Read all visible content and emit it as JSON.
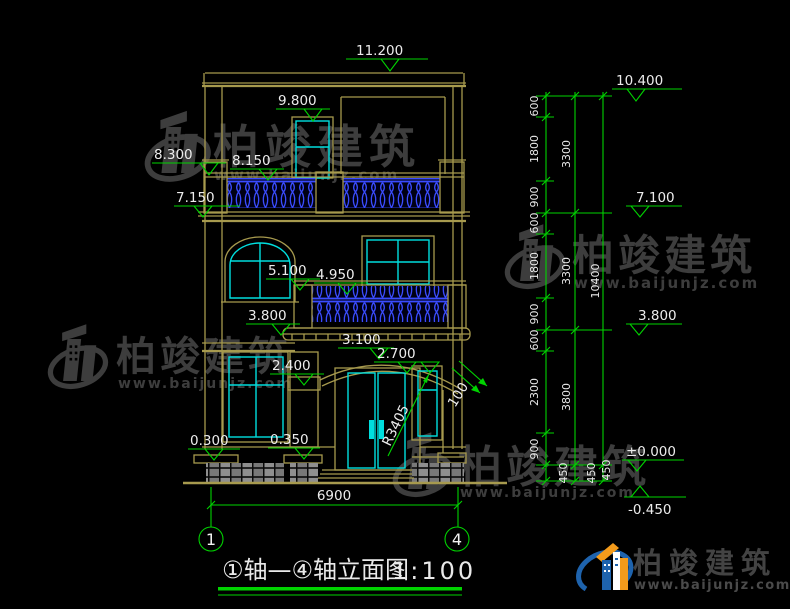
{
  "title": {
    "text": "①轴—④轴立面图",
    "scale": "1:100"
  },
  "axes": {
    "first": "1",
    "last": "4"
  },
  "elev_left": [
    "11.200",
    "9.800",
    "8.300",
    "8.150",
    "7.150",
    "5.100",
    "4.950",
    "3.800",
    "3.100",
    "2.700",
    "2.400",
    "0.300",
    "0.350"
  ],
  "elev_right": [
    "10.400",
    "7.100",
    "3.800",
    "±0.000",
    "-0.450"
  ],
  "chain_inner": [
    "600",
    "1800",
    "900",
    "600",
    "1800",
    "900",
    "600",
    "2300",
    "900",
    "450"
  ],
  "chain_mid": [
    "3300",
    "3300",
    "3800",
    "450"
  ],
  "chain_outer": [
    "10400",
    "450"
  ],
  "dims": {
    "overall_width": "6900",
    "door_arch_radius": "R3405",
    "arch_offset": "100"
  },
  "watermark": {
    "brand": "柏竣建筑",
    "url": "www.baijunjz.com"
  },
  "logo": {
    "brand": "柏竣建筑",
    "url": "www.baijunjz.com"
  },
  "colors": {
    "outline": "#a79a4e",
    "glazing": "#00dede",
    "dimension": "#00d300",
    "baluster": "#3a4cff",
    "text": "#ececec"
  }
}
